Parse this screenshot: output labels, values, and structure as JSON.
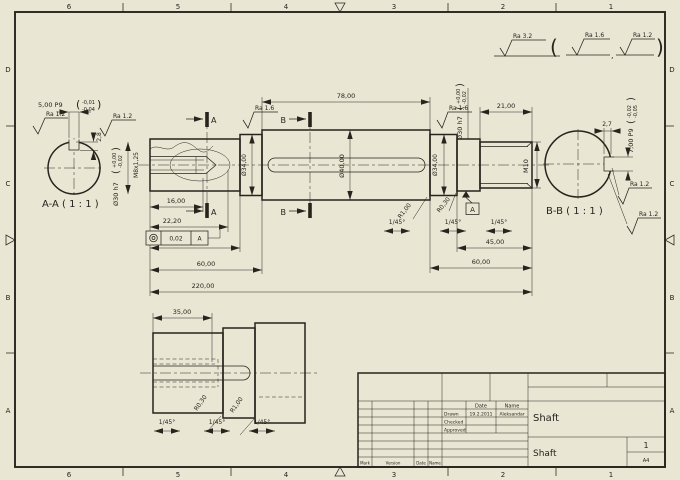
{
  "sheet": {
    "bg": "#e9e6d4",
    "ink": "#26241d",
    "zones": {
      "top": [
        "6",
        "5",
        "4",
        "3",
        "2",
        "1"
      ],
      "bottom": [
        "6",
        "5",
        "4",
        "3",
        "2",
        "1"
      ],
      "left": [
        "D",
        "C",
        "B",
        "A"
      ],
      "right": [
        "D",
        "C",
        "B",
        "A"
      ]
    }
  },
  "punct": {
    "open": "(",
    "close": ")",
    "comma": ","
  },
  "roughness": {
    "general": "Ra 3.2",
    "alt1": "Ra 1.6",
    "alt2": "Ra 1.2",
    "aa_left": "Ra 1.2",
    "aa_right": "Ra 1.2",
    "shaft_left": "Ra 1.6",
    "shaft_right": "Ra 1.6",
    "bb_upper": "Ra 1.2",
    "bb_lower": "Ra 1.2"
  },
  "views": {
    "section_a_label": "A-A ( 1 : 1 )",
    "section_b_label": "B-B ( 1 : 1 )",
    "cut_a": "A",
    "cut_b": "B"
  },
  "dims": {
    "aa_key_width": "5,00 P9",
    "aa_key_tol_hi": "-0,01",
    "aa_key_tol_lo": "-0,04",
    "aa_dia": "Ø30 h7",
    "aa_dia_tol_hi": "+0,00",
    "aa_dia_tol_lo": "-0,02",
    "aa_key_depth": "2,8",
    "thread_left": "M8x1,25",
    "len_thread": "16,00",
    "len_hole": "22,20",
    "tol_frame_value": "0,02",
    "tol_frame_datum": "A",
    "len45_left": "45,00",
    "len60_left": "60,00",
    "len_total": "220,00",
    "len78": "78,00",
    "dia40": "Ø40,00",
    "dia34_left": "Ø34,00",
    "dia34_right": "Ø34,00",
    "dia30": "Ø30 h7",
    "dia30_tol_hi": "+0,00",
    "dia30_tol_lo": "-0,02",
    "len21": "21,00",
    "thread_right": "M10",
    "len45_right": "45,00",
    "len60_right": "60,00",
    "chamfer": "1/45°",
    "radius_small": "R0,30",
    "radius_big": "R1,00",
    "len35": "35,00",
    "bb_key_width": "7,00 P9",
    "bb_key_tol_hi": "-0,02",
    "bb_key_tol_lo": "-0,05",
    "bb_key_depth": "2,7",
    "datum": "A"
  },
  "titleblock": {
    "col_date": "Date",
    "col_name": "Name",
    "rows": [
      {
        "label": "Drawn",
        "date": "19.2.2011",
        "name": "Aleksandar"
      },
      {
        "label": "Checked",
        "date": "",
        "name": ""
      },
      {
        "label": "Approved",
        "date": "",
        "name": ""
      }
    ],
    "bottom_headers": [
      "Mark",
      "Version",
      "Date",
      "Name"
    ],
    "part_title": "Shaft",
    "part_name": "Shaft",
    "sheet_no": "1",
    "format": "A4"
  }
}
